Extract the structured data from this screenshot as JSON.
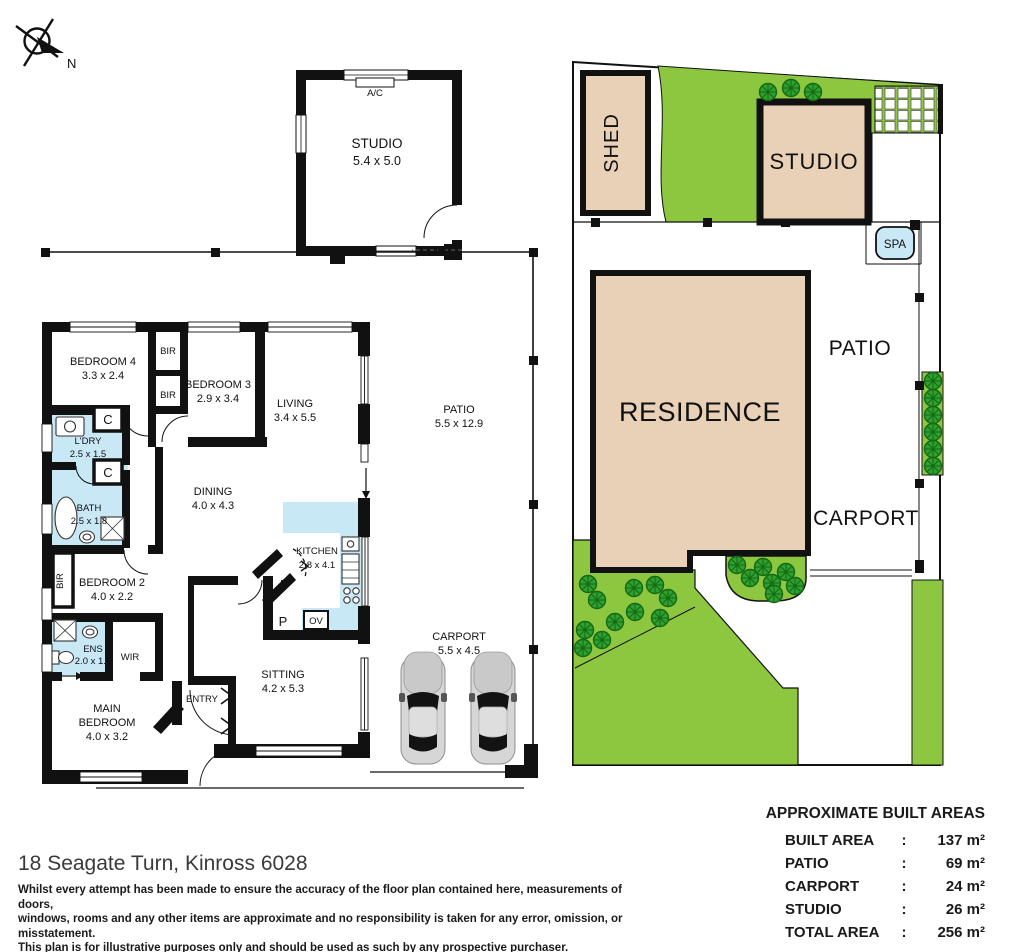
{
  "compass": {
    "label": "N"
  },
  "studio_plan": {
    "label": "STUDIO",
    "dims": "5.4 x 5.0",
    "ac": "A/C"
  },
  "rooms": {
    "bedroom4": {
      "name": "BEDROOM 4",
      "dims": "3.3 x 2.4"
    },
    "bir_top": "BIR",
    "bir_mid": "BIR",
    "bir_left": "BIR",
    "bedroom3": {
      "name": "BEDROOM 3",
      "dims": "2.9 x 3.4"
    },
    "living": {
      "name": "LIVING",
      "dims": "3.4 x 5.5"
    },
    "patio": {
      "name": "PATIO",
      "dims": "5.5 x 12.9"
    },
    "cupboard1": "C",
    "cupboard2": "C",
    "ldry": {
      "name": "L'DRY",
      "dims": "2.5 x 1.5"
    },
    "bath": {
      "name": "BATH",
      "dims": "2.5 x 1.8"
    },
    "dining": {
      "name": "DINING",
      "dims": "4.0 x 4.3"
    },
    "bedroom2": {
      "name": "BEDROOM 2",
      "dims": "4.0 x 2.2"
    },
    "kitchen": {
      "name": "KITCHEN",
      "dims": "2.8 x 4.1"
    },
    "fridge": "F",
    "pantry": "P",
    "oven": "OV",
    "ens": {
      "name": "ENS",
      "dims": "2.0 x 1.6"
    },
    "wir": "WIR",
    "entry": "ENTRY",
    "main_bedroom": {
      "line1": "MAIN",
      "line2": "BEDROOM",
      "dims": "4.0 x 3.2"
    },
    "sitting": {
      "name": "SITTING",
      "dims": "4.2 x 5.3"
    },
    "carport": {
      "name": "CARPORT",
      "dims": "5.5 x 4.5"
    }
  },
  "site_plan": {
    "shed": "SHED",
    "studio": "STUDIO",
    "spa": "SPA",
    "residence": "RESIDENCE",
    "patio": "PATIO",
    "carport": "CARPORT"
  },
  "footer": {
    "address": "18 Seagate Turn, Kinross 6028",
    "disclaimer_line1": "Whilst every attempt has been made to ensure the accuracy of the floor plan contained here, measurements of doors,",
    "disclaimer_line2": "windows, rooms and any other items are approximate and no responsibility is taken for any error, omission, or misstatement.",
    "disclaimer_line3": "This plan is for illustrative purposes only and should be used as such by any prospective purchaser."
  },
  "areas_table": {
    "title": "APPROXIMATE BUILT AREAS",
    "rows": [
      {
        "label": "BUILT AREA",
        "sep": ":",
        "value": "137 m²"
      },
      {
        "label": "PATIO",
        "sep": ":",
        "value": "69 m²"
      },
      {
        "label": "CARPORT",
        "sep": ":",
        "value": "24 m²"
      },
      {
        "label": "STUDIO",
        "sep": ":",
        "value": "26 m²"
      },
      {
        "label": "TOTAL AREA",
        "sep": ":",
        "value": "256 m²"
      }
    ]
  },
  "colors": {
    "wet_area": "#c9e8f6",
    "site_building": "#e9d1b8",
    "lawn": "#8dc63f",
    "tree": "#2da02d",
    "wall": "#111111"
  }
}
